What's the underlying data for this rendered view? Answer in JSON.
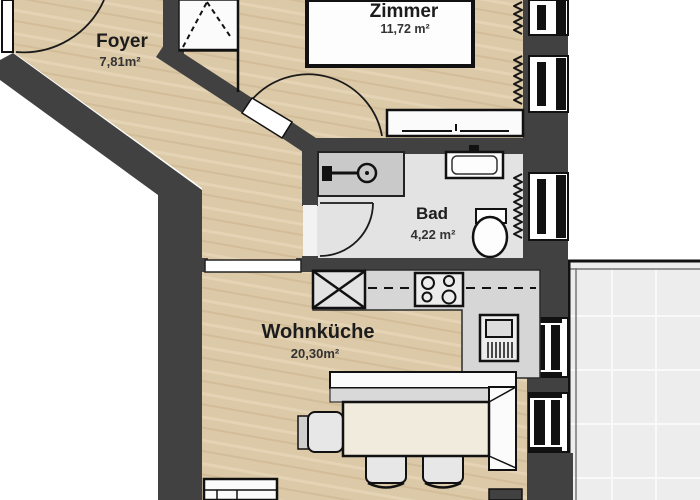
{
  "document": {
    "kind": "apartment-floor-plan",
    "language": "de"
  },
  "rooms": [
    {
      "id": "zimmer",
      "label": "Zimmer",
      "area": "11,72 m²"
    },
    {
      "id": "foyer",
      "label": "Foyer",
      "area": "7,81m²"
    },
    {
      "id": "bad",
      "label": "Bad",
      "area": "4,22 m²"
    },
    {
      "id": "wohnkueche",
      "label": "Wohnküche",
      "area": "20,30m²"
    }
  ],
  "colors": {
    "wall": "#414141",
    "wood": "#dcc9a8",
    "wood_streak_light": "#e4d3b5",
    "wood_streak_dark": "#d2bd98",
    "bath_floor": "#e3e3e3",
    "counter": "#d6d6d6",
    "shower": "#c9c9c9",
    "appliance": "#ececec",
    "balcony": "#ededed",
    "balcony_grid": "#f9f9f9",
    "furniture": "#fbfbfb",
    "table": "#f0ebdd",
    "chair": "#e7e7e7",
    "chair_back": "#cfcfcf",
    "outline": "#111111",
    "text": "#1c1c1c",
    "text_area": "#333333"
  }
}
